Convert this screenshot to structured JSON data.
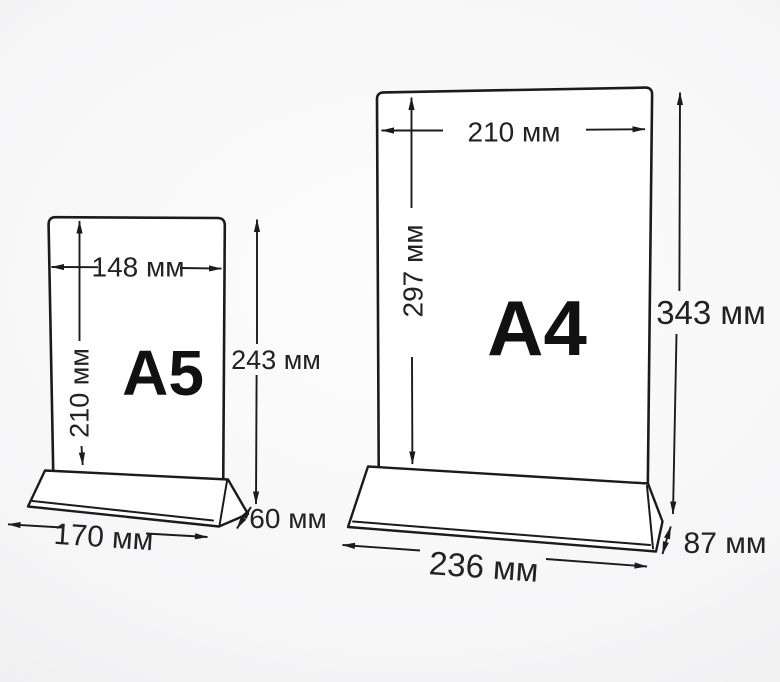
{
  "diagram": {
    "description_unit": "мм",
    "colors": {
      "line": "#1b1b1b",
      "text": "#222222",
      "panel_fill": "#ffffff",
      "background_center": "#fdfdfd",
      "background_edge": "#e9e9eb"
    },
    "stands": {
      "a5": {
        "name": "A5",
        "paper_width": "148 мм",
        "paper_height": "210 мм",
        "total_height": "243 мм",
        "base_width": "170 мм",
        "base_depth": "60 мм",
        "dimensions_mm": {
          "paper_width": 148,
          "paper_height": 210,
          "total_height": 243,
          "base_width": 170,
          "base_depth": 60
        }
      },
      "a4": {
        "name": "A4",
        "paper_width": "210 мм",
        "paper_height": "297 мм",
        "total_height": "343 мм",
        "base_width": "236 мм",
        "base_depth": "87 мм",
        "dimensions_mm": {
          "paper_width": 210,
          "paper_height": 297,
          "total_height": 343,
          "base_width": 236,
          "base_depth": 87
        }
      }
    }
  }
}
